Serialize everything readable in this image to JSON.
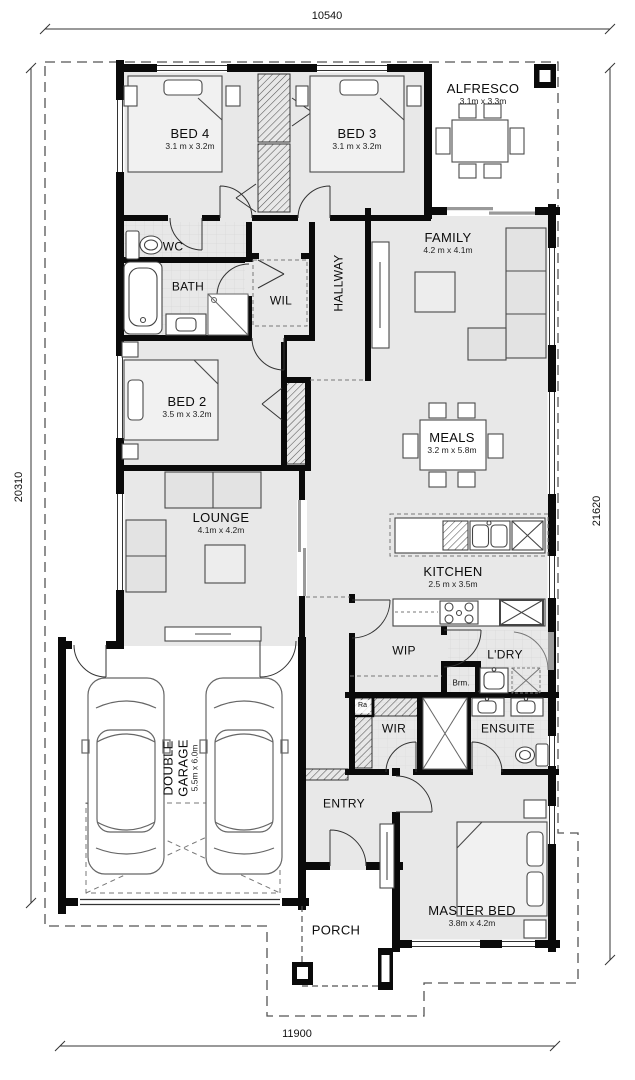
{
  "dimensions": {
    "top": "10540",
    "bottom": "11900",
    "left": "20310",
    "right": "21620"
  },
  "rooms": {
    "bed4": {
      "name": "BED 4",
      "size": "3.1 m x 3.2m"
    },
    "bed3": {
      "name": "BED 3",
      "size": "3.1 m x 3.2m"
    },
    "alfresco": {
      "name": "ALFRESCO",
      "size": "3.1m x 3.3m"
    },
    "wc": {
      "name": "WC"
    },
    "bath": {
      "name": "BATH"
    },
    "wil": {
      "name": "WIL"
    },
    "hallway": {
      "name": "HALLWAY"
    },
    "family": {
      "name": "FAMILY",
      "size": "4.2 m x 4.1m"
    },
    "bed2": {
      "name": "BED 2",
      "size": "3.5 m x 3.2m"
    },
    "meals": {
      "name": "MEALS",
      "size": "3.2 m x 5.8m"
    },
    "lounge": {
      "name": "LOUNGE",
      "size": "4.1m x 4.2m"
    },
    "kitchen": {
      "name": "KITCHEN",
      "size": "2.5 m x 3.5m"
    },
    "wip": {
      "name": "WIP"
    },
    "ldry": {
      "name": "L'DRY"
    },
    "brm": {
      "name": "Brm."
    },
    "ra": {
      "name": "Ra"
    },
    "wir": {
      "name": "WIR"
    },
    "ensuite": {
      "name": "ENSUITE"
    },
    "entry": {
      "name": "ENTRY"
    },
    "garage": {
      "name": "DOUBLE GARAGE",
      "size": "5.5m x 6.0m"
    },
    "master": {
      "name": "MASTER BED",
      "size": "3.8m x 4.2m"
    },
    "porch": {
      "name": "PORCH"
    }
  },
  "colors": {
    "wall": "#0a0a0a",
    "floor": "#e8e8e8",
    "boundary_dash": "#555",
    "furniture": "#4a4a4a"
  }
}
